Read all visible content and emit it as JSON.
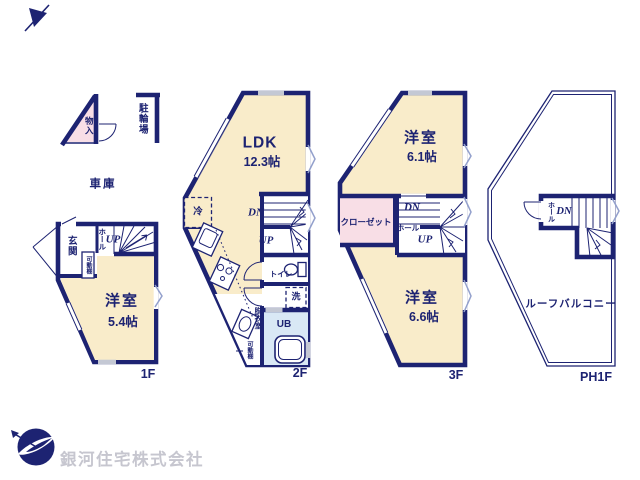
{
  "colors": {
    "wall": "#1d2372",
    "room_fill": "#f9ecca",
    "closet_fill": "#f8dee6",
    "bath_fill": "#d9e8f5",
    "window_accent": "#93a0cc",
    "fitting_band": "#c4c8d4",
    "company_text": "#c6c6cf"
  },
  "floor1": {
    "label": "1F",
    "storage": "物入",
    "bicycle_parking": "駐輪場",
    "garage": "車庫",
    "entrance": "玄関",
    "hall": "ホール",
    "stairs_up": "UP",
    "shelf": "可動棚",
    "bedroom_name": "洋室",
    "bedroom_size": "5.4帖"
  },
  "floor2": {
    "label": "2F",
    "ldk_name": "LDK",
    "ldk_size": "12.3帖",
    "fridge": "冷",
    "stairs_down": "DN",
    "stairs_up": "UP",
    "toilet": "トイレ",
    "laundry": "洗",
    "dressing_room": "脱衣室",
    "bath": "UB",
    "shelf": "可動棚"
  },
  "floor3": {
    "label": "3F",
    "bedroom1_name": "洋室",
    "bedroom1_size": "6.1帖",
    "closet": "クローゼット",
    "stairs_down": "DN",
    "hall": "ホール",
    "stairs_up": "UP",
    "bedroom2_name": "洋室",
    "bedroom2_size": "6.6帖"
  },
  "floor_ph": {
    "label": "PH1F",
    "hall": "ホール",
    "stairs_down": "DN",
    "roof_balcony": "ルーフバルコニー"
  },
  "footer": {
    "company_name": "銀河住宅株式会社"
  }
}
